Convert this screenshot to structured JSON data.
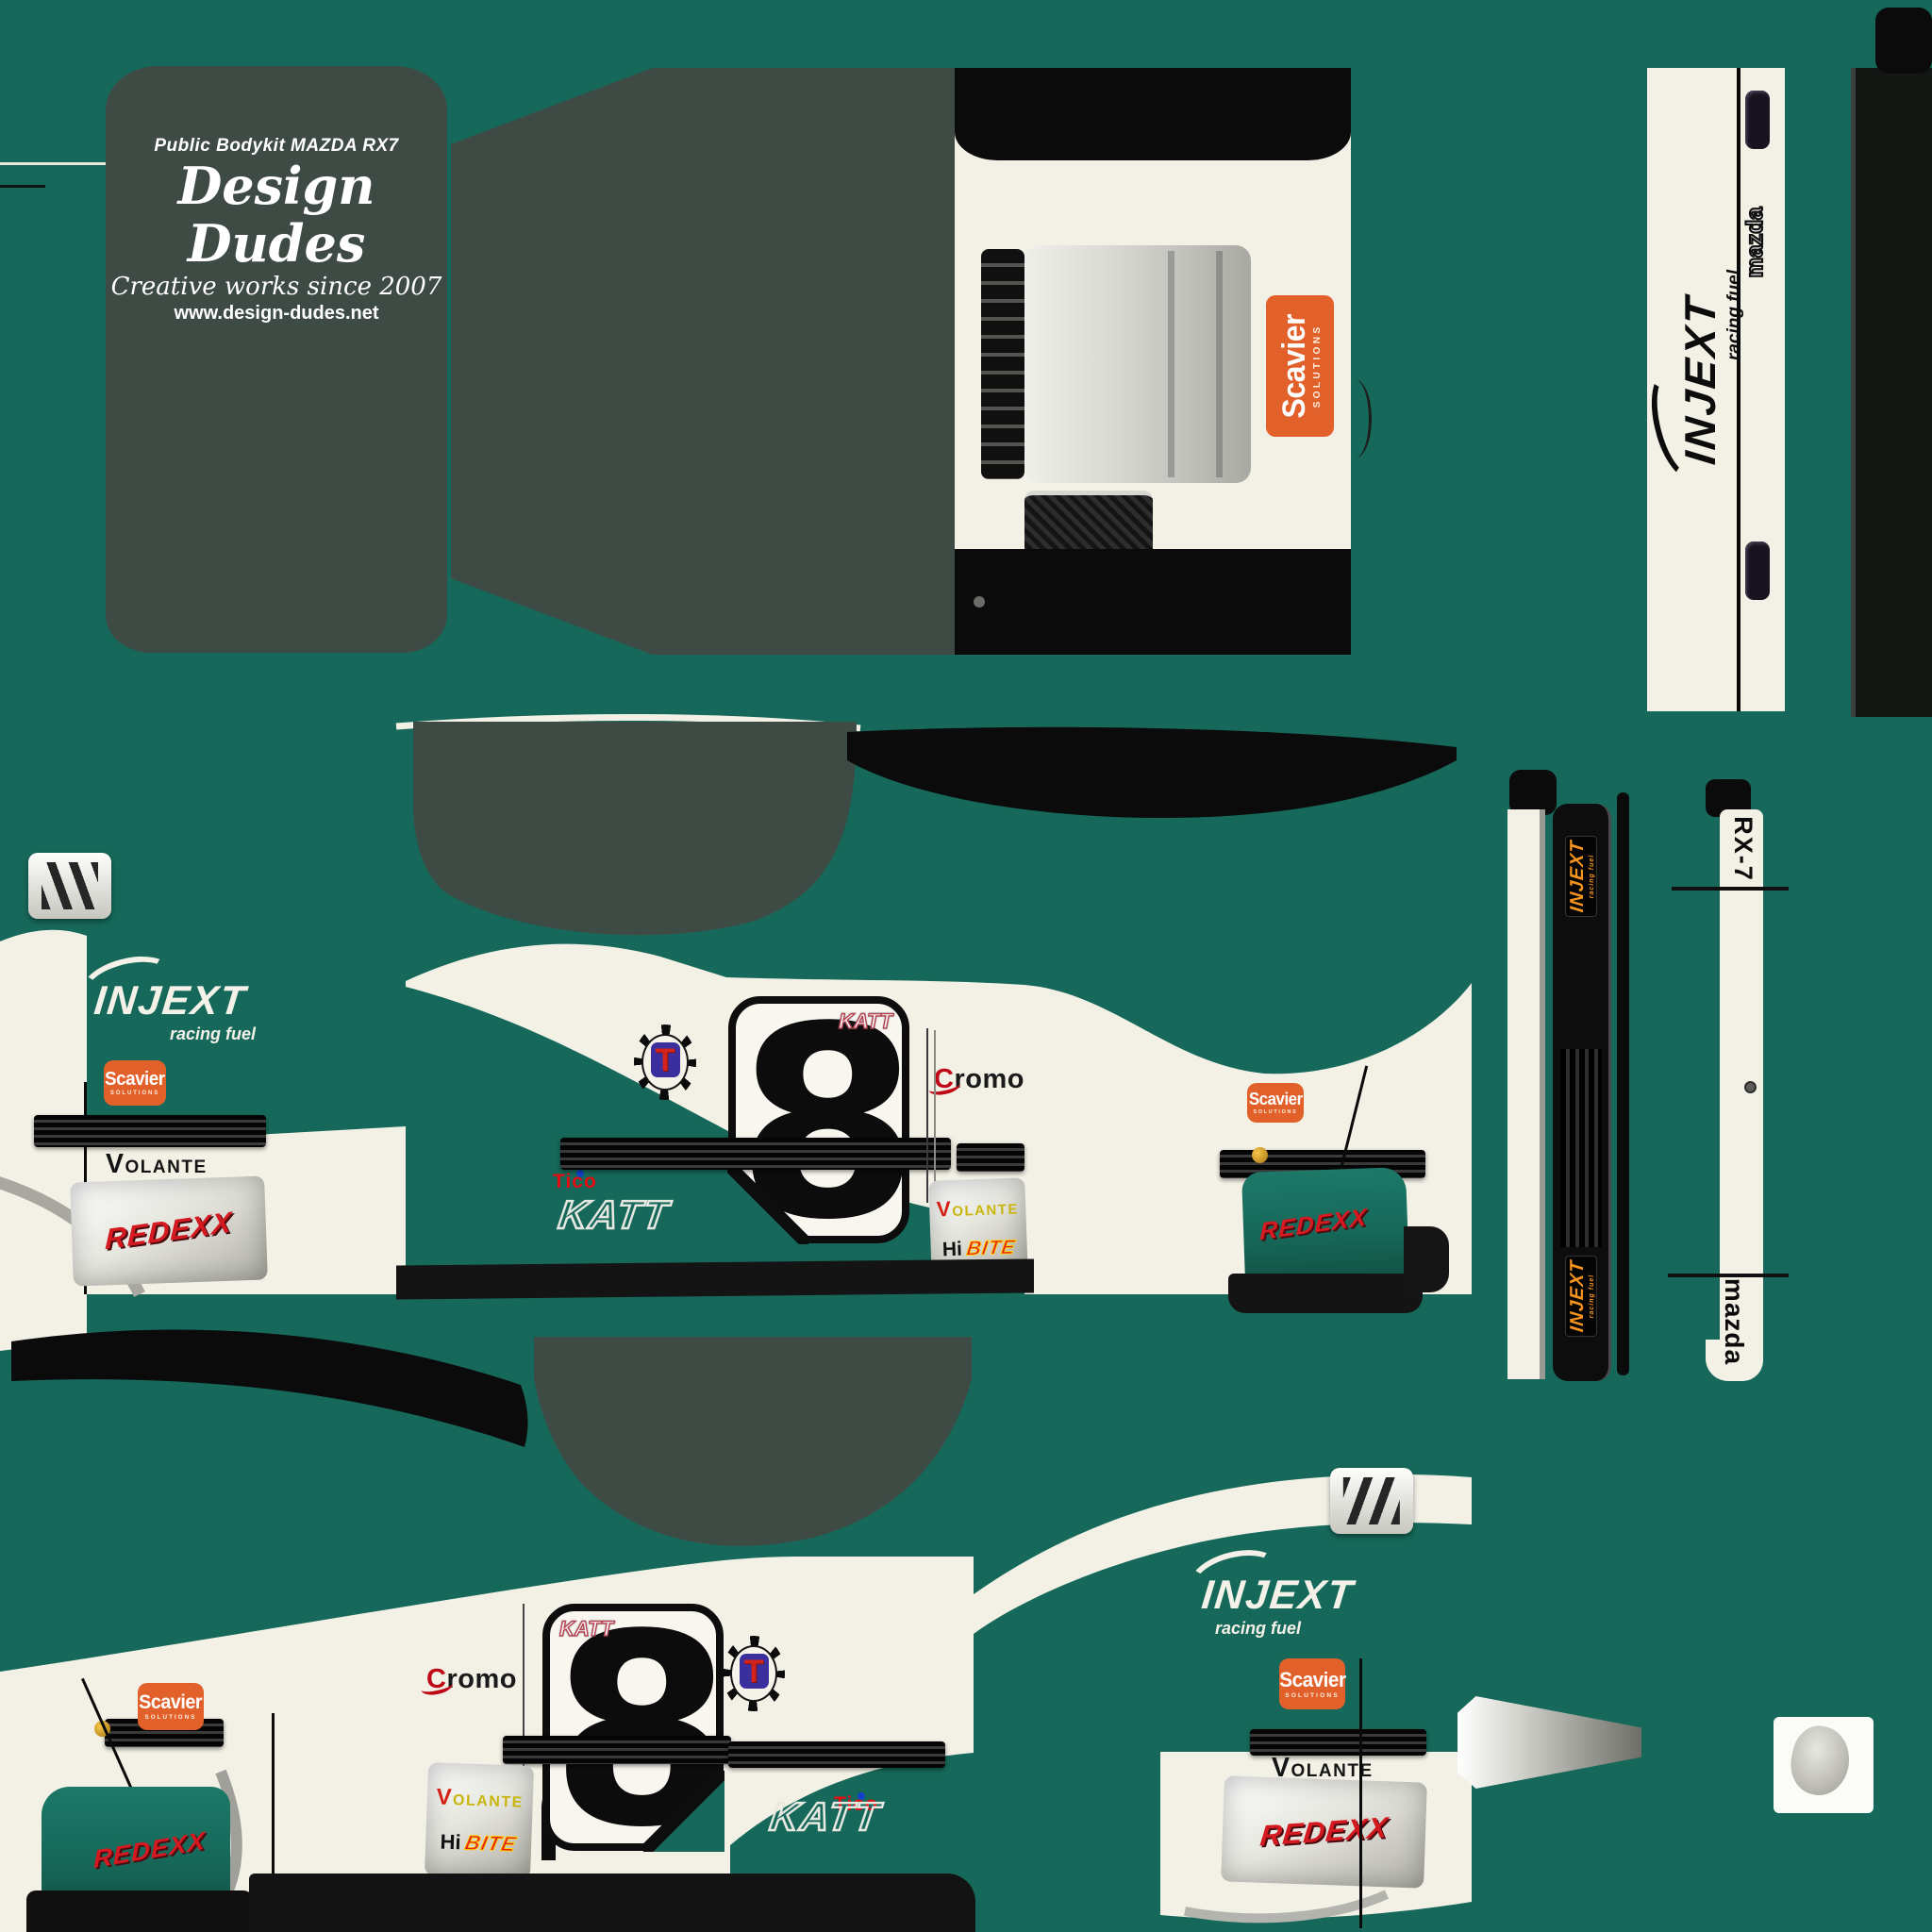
{
  "meta": {
    "description": "Racing livery texture sheet for a public bodykit Mazda RX-7, green/white scheme, car number 8"
  },
  "watermark": {
    "line1": "Public Bodykit MAZDA RX7",
    "line2": "Design Dudes",
    "line3": "Creative works since 2007",
    "line4": "www.design-dudes.net"
  },
  "car": {
    "number": "8",
    "model": "RX-7",
    "make": "mazda"
  },
  "sponsors": {
    "injext": {
      "name": "INJEXT",
      "tagline": "racing fuel"
    },
    "scavier": {
      "name": "Scavier",
      "tagline": "SOLUTIONS"
    },
    "volante": {
      "name": "VOLANTE"
    },
    "redexx": {
      "name": "REDEXX"
    },
    "cromo": {
      "name": "Cromo"
    },
    "tico": {
      "name": "Tico"
    },
    "hibite": {
      "prefix": "Hi",
      "name": "BITE"
    },
    "katt": {
      "name": "KATT"
    },
    "emblem": {
      "letter": "T"
    }
  },
  "colors": {
    "body_green": "#16695A",
    "roof_dark": "#3E4B44",
    "body_cream": "#F3F1E6",
    "trim_black": "#0B0B0B",
    "scavier_orange": "#E2612B",
    "injext_badge_orange": "#F7941D",
    "redexx_red": "#D41920",
    "tico_red": "#E60D12",
    "volante_yellow": "#C8B50C",
    "hibite_red": "#E62019",
    "hibite_outline_yellow": "#FFD300"
  }
}
